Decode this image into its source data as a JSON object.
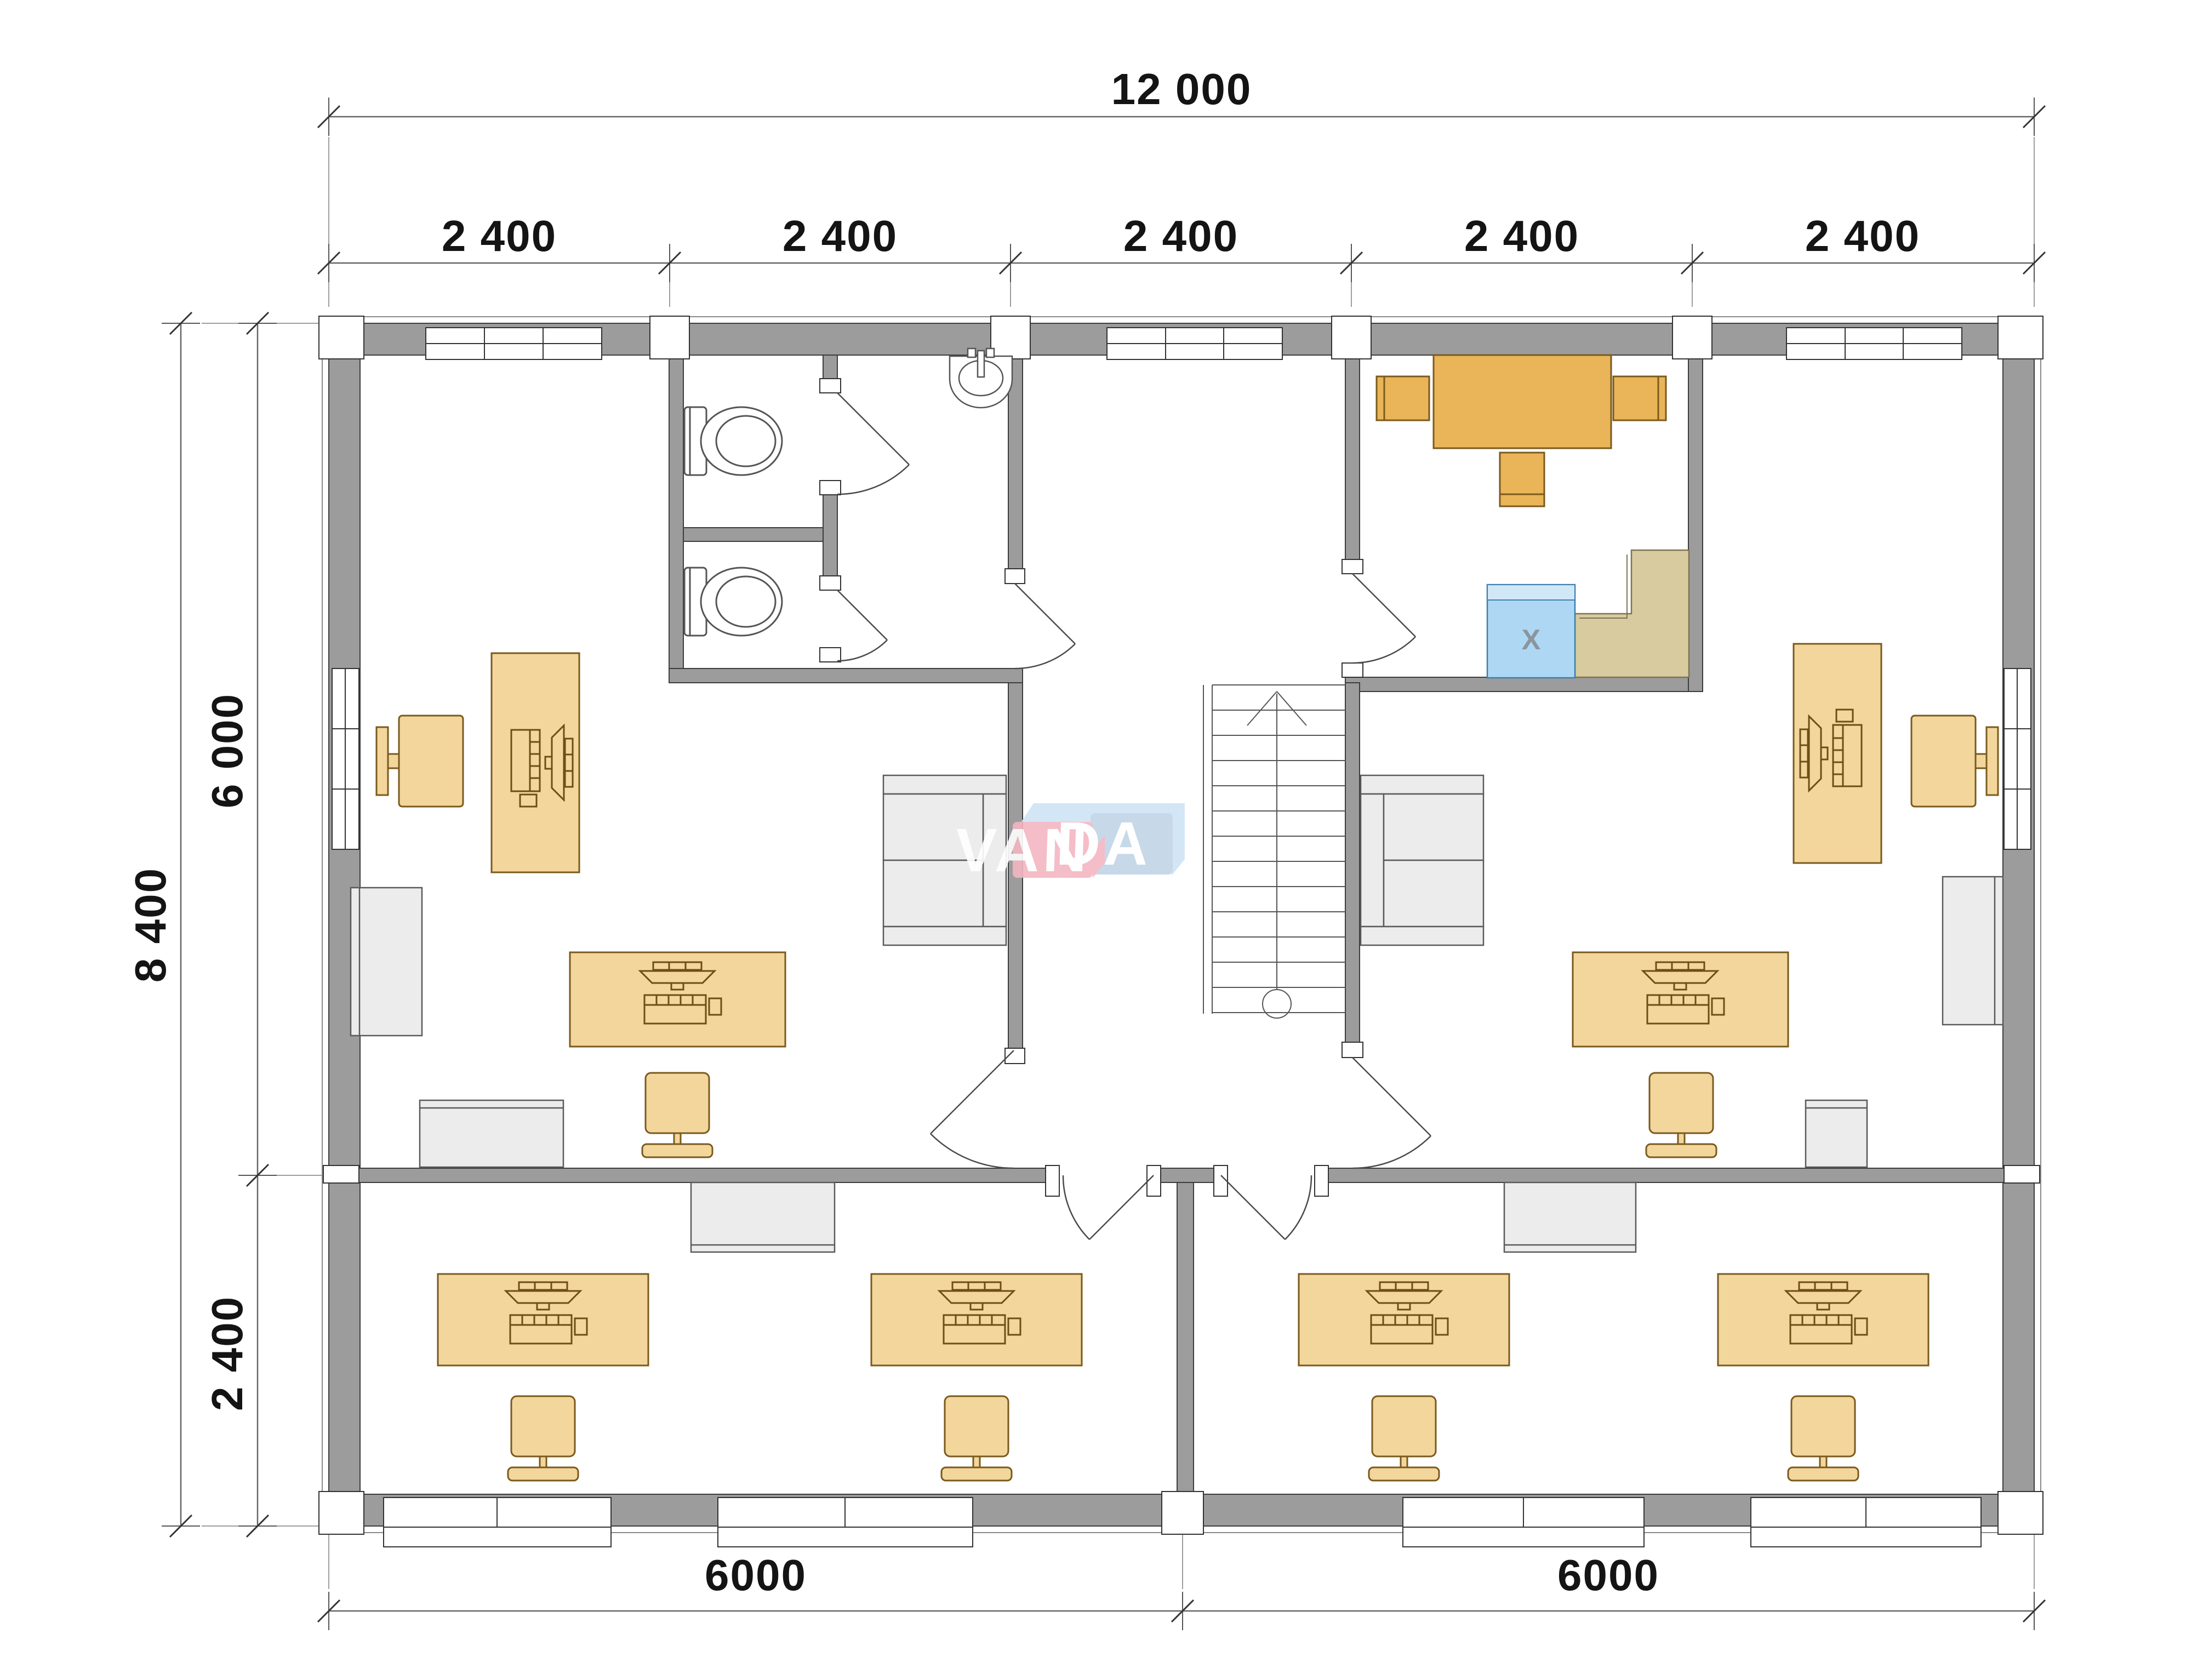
{
  "document_type": "floor-plan-drawing",
  "dimensions": {
    "overall_width": "12 000",
    "bays": [
      "2 400",
      "2 400",
      "2 400",
      "2 400",
      "2 400"
    ],
    "overall_depth": "8 400",
    "upper_depth": "6 000",
    "lower_depth": "2 400",
    "bottom_left_span": "6000",
    "bottom_right_span": "6000"
  },
  "watermark": {
    "part1": "VAN",
    "part2": "DA"
  },
  "kitchen": {
    "appliance_mark": "X"
  },
  "colors": {
    "wall": "#9c9c9c",
    "wall_stroke": "#3d3d3d",
    "white": "#ffffff",
    "desk_light": "#f3d69b",
    "furniture_strong": "#e9b558",
    "furniture_stroke": "#7a5a1d",
    "gray_furniture": "#ececec",
    "counter_tan": "#d7cb9f",
    "appliance_blue": "#aed7f3",
    "appliance_blue_top": "#d0e7f8",
    "watermark_pink": "#f3b6c1",
    "watermark_blue": "#c2d4e6",
    "dimension_text": "#141414"
  },
  "inventory": {
    "workstation_desks": 8,
    "office_chairs": 8,
    "conference_tables": 1,
    "conference_chairs": 3,
    "sofas": 2,
    "cabinets": 6,
    "toilets": 2,
    "sinks": 1,
    "staircases": 1,
    "appliances": 1,
    "counters": 1
  }
}
